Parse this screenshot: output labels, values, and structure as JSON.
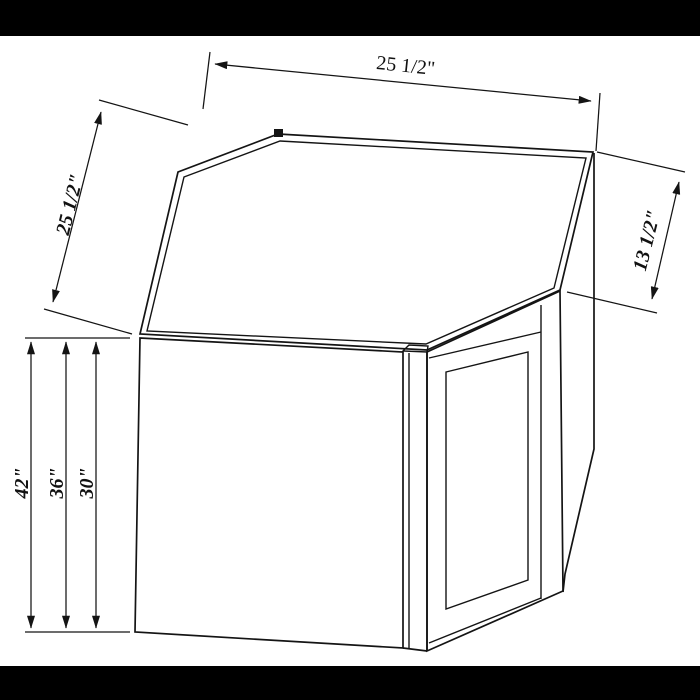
{
  "figure": {
    "type": "technical-line-drawing",
    "subject": "diagonal corner wall cabinet with shaker door",
    "colors": {
      "line": "#141414",
      "background": "#ffffff",
      "letterbox": "#000000"
    },
    "dimensions": {
      "top_width": "25 1/2\"",
      "left_width": "25 1/2\"",
      "right_depth": "13 1/2\"",
      "height_options": [
        "42\"",
        "36\"",
        "30\""
      ]
    }
  }
}
